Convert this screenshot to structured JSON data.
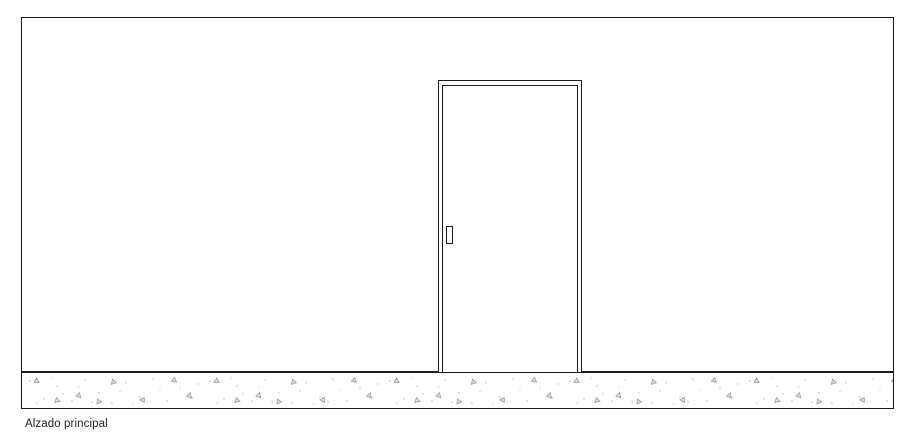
{
  "drawing": {
    "caption": "Alzado principal",
    "elements": {
      "wall": "exterior wall elevation outline",
      "door_frame": "door outer frame",
      "door_leaf": "door leaf",
      "door_handle": "door handle plate",
      "ground": "concrete ground strip with stipple hatch"
    },
    "colors": {
      "line": "#1c1c1c",
      "background": "#ffffff",
      "hatch_dot": "#b8b8b8",
      "hatch_triangle_stroke": "#9e9e9e",
      "hatch_triangle_fill": "#dcdcdc"
    }
  }
}
